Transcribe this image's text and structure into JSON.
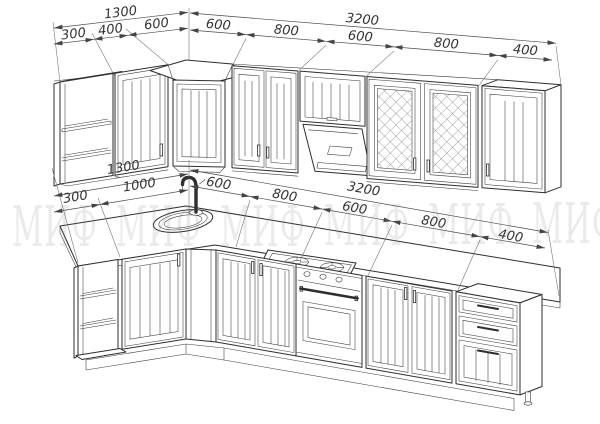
{
  "watermark": {
    "text": "МИФ"
  },
  "palette": {
    "line": "#2e2e2e",
    "dim_line": "#4a4a4a",
    "dim_text": "#333333",
    "watermark_gray": "#e9e9e9",
    "background": "#ffffff"
  },
  "dimensions_mm": {
    "upper_row": {
      "left_total": "1300",
      "left_segments": [
        "300",
        "400",
        "600"
      ],
      "back_total": "3200",
      "back_segments": [
        "600",
        "800",
        "600",
        "800",
        "400"
      ]
    },
    "base_row": {
      "left_total": "1300",
      "left_segments": [
        "300",
        "1000"
      ],
      "back_total": "3200",
      "back_segments": [
        "600",
        "800",
        "600",
        "800",
        "400"
      ]
    }
  }
}
